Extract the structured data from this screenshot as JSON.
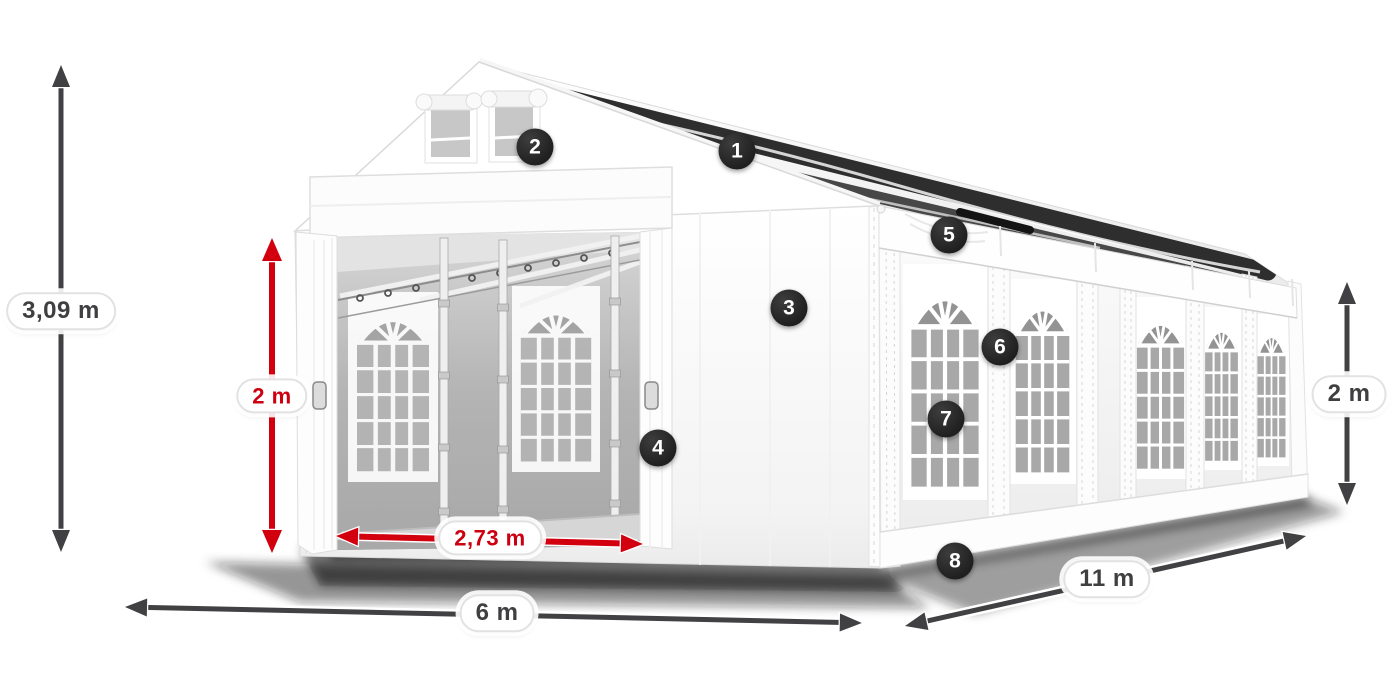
{
  "diagram": {
    "subject": "white marquee party tent, perspective product dimension diagram",
    "dimensions": [
      {
        "id": "total-height",
        "label": "3,09 m",
        "style": "dark"
      },
      {
        "id": "door-height",
        "label": "2 m",
        "style": "red"
      },
      {
        "id": "door-width",
        "label": "2,73 m",
        "style": "red"
      },
      {
        "id": "front-width",
        "label": "6 m",
        "style": "dark"
      },
      {
        "id": "side-length",
        "label": "11 m",
        "style": "dark"
      },
      {
        "id": "side-height",
        "label": "2 m",
        "style": "dark"
      }
    ],
    "callouts": [
      {
        "number": "1"
      },
      {
        "number": "2"
      },
      {
        "number": "3"
      },
      {
        "number": "4"
      },
      {
        "number": "5"
      },
      {
        "number": "6"
      },
      {
        "number": "7"
      },
      {
        "number": "8"
      }
    ],
    "colors": {
      "red": "#d2000f",
      "dark": "#414042",
      "badge_bg": "#242424",
      "badge_text": "#ffffff",
      "background": "#ffffff"
    }
  }
}
